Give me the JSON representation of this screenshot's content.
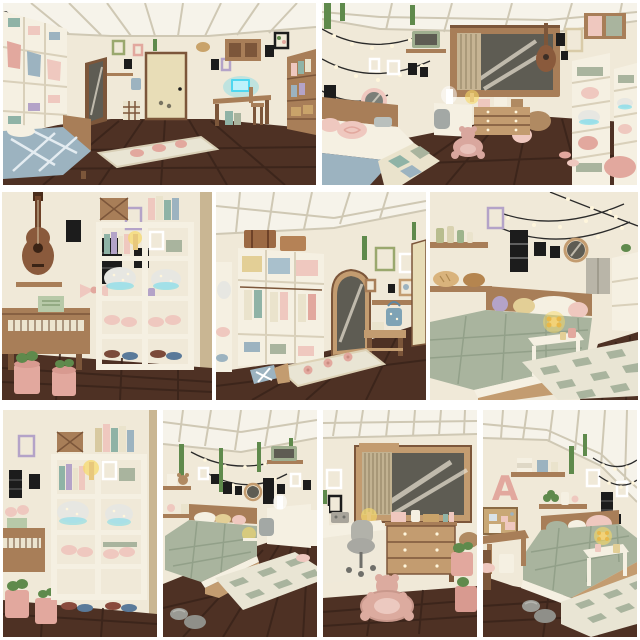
{
  "collage": {
    "name": "bloxburg-bedroom-build-collage",
    "rows": 3,
    "panel_count": 9
  },
  "panels": [
    {
      "id": "top-left",
      "description": "Bedroom overview facing a cream door: white wardrobe shelves with hanging pastel clothes, leaning mirror, wall frames, desk with glowing blue laptop, bookshelf, blue patterned bed and beige runner rug on dark wood floor"
    },
    {
      "id": "top-right",
      "description": "Bedroom overview: string lights and vines, round pink mirror, shelf TV, large gray window with curtain, guitar, white shelf towers with pink pillows and sparkle bags, pink bed with checkered quilt, desk, dresser and teddy-bear rug"
    },
    {
      "id": "middle-left",
      "description": "Music wall close-up: hanging acoustic guitar, black frames, pink bow, wooden piano with green sheet music, white shelf with pastel books, sparkle bags, pink slippers, and pink plant pots"
    },
    {
      "id": "middle-center",
      "description": "White wardrobe with yellow, blue and pink bins and hanging clothes, suitcases on top, arched wood floor mirror, green frame, hook shelf with blue bag, wooden bench, flower rug and blue pillow"
    },
    {
      "id": "middle-right",
      "description": "Sage quilted bed close-up with wooden base, pastel pillows, white side table with glowing flower lamp, wood shelves with bottles and bread baskets, black frames, round mirror, string lights and checkered rug"
    },
    {
      "id": "bottom-1",
      "description": "White shelf close-up: pastel books, glowing candle, sparkle bags with blue glow, pink slippers, dark slippers below, piano edge, black frames and pink pots"
    },
    {
      "id": "bottom-2",
      "description": "Bedroom corner: sage bed with glowing lamp, string lights, hanging vines, wall shelves with teddy, corner TV shelf, white desk with chair, checkered rug and gray rock cushions"
    },
    {
      "id": "bottom-3",
      "description": "Desk corner: large wood-framed window with vertical blinds and light streaks, white desk with radio and candle, gray office chair, wooden dresser with white knobs, pink pots and pink teddy-bear rug"
    },
    {
      "id": "bottom-4",
      "description": "Bed corner: pink letter-A wall decor, pinboard, wood shelves with towels, plants and vases, vines, string lights, sage bed with pink pillow, white table with glowing lamp, small wooden desk with bin, checkered rug and gray rocks",
      "decor_letter": "A"
    }
  ],
  "palette": {
    "background": "#ffffff",
    "wall": "#f0e9d8",
    "wall_shadow": "#ddd3bd",
    "ceiling": "#f6f3ea",
    "ceiling_shadow": "#cfc8b4",
    "floor": "#4e3124",
    "floor_line": "#39231a",
    "wood": "#a87e58",
    "wood_dark": "#7c563a",
    "wood_light": "#c39c70",
    "white_furniture": "#f5f0e2",
    "white_shadow": "#d9d0ba",
    "door": "#e8ddb7",
    "glass": "#5e5c53",
    "glass_streak": "#e9e3d3",
    "sage": "#a9b49e",
    "sage_dark": "#92a089",
    "pink": "#e2a89e",
    "pink_light": "#efc8bf",
    "blue": "#9cb3c0",
    "teal": "#8fb3a6",
    "lavender": "#b4a3c8",
    "yellow": "#e3cf96",
    "vine": "#5f8a4c",
    "glow_blue": "#4ed7f0",
    "glow_yellow": "#f6d868",
    "black": "#1c1c1c",
    "gray": "#9b9b95",
    "wire": "#2a2a2a",
    "light_dot": "#fff6dc",
    "cream": "#eae3cc",
    "tan": "#c9a36a",
    "tan_dark": "#b08a62",
    "rug": "#e9e5d4",
    "sparkle": "#e7e7e2"
  }
}
